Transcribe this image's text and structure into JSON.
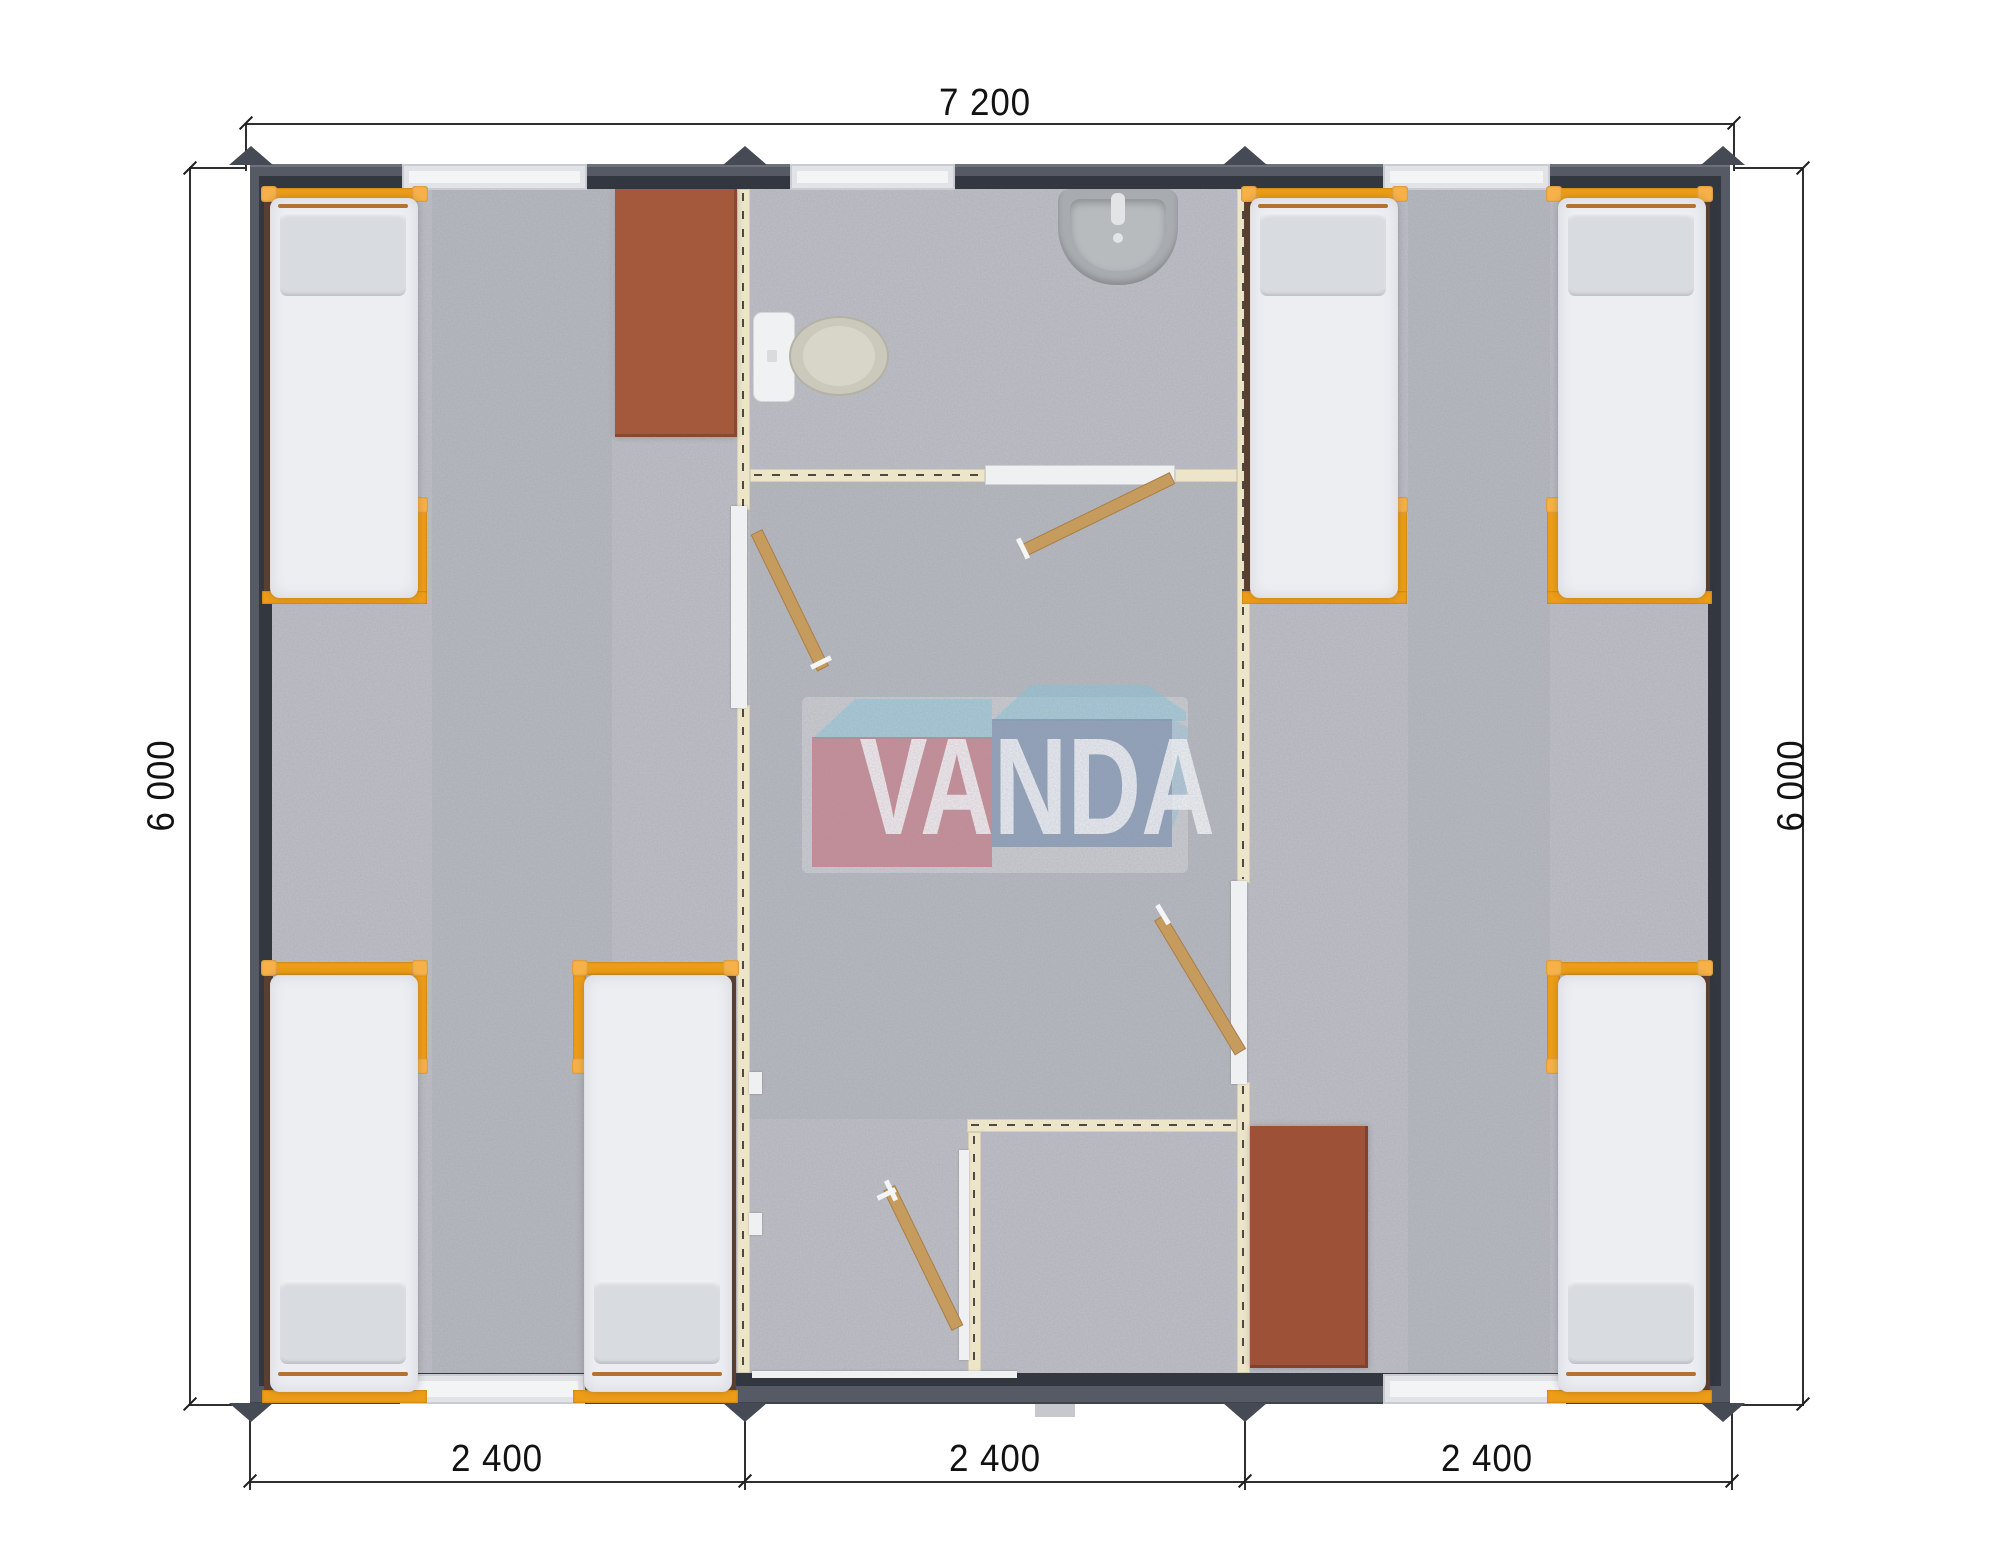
{
  "drawing": {
    "logo_text": "VANDA",
    "dimensions": {
      "top": "7 200",
      "left": "6 000",
      "right": "6 000",
      "bottom": [
        "2 400",
        "2 400",
        "2 400"
      ]
    },
    "colors": {
      "wall_outer": "#555a65",
      "wall_inner": "#33373f",
      "partition_cream": "#ede5c9",
      "floor_gray": "#bfc0c6",
      "frame_orange": "#ee9d18",
      "desk_brown": "#a4593c",
      "door_wood": "#c69c5e",
      "logo_red": "#c65e6d",
      "logo_blue": "#6a86aa",
      "logo_cyan": "#89c8dd",
      "dimension_text": "#121212"
    }
  }
}
